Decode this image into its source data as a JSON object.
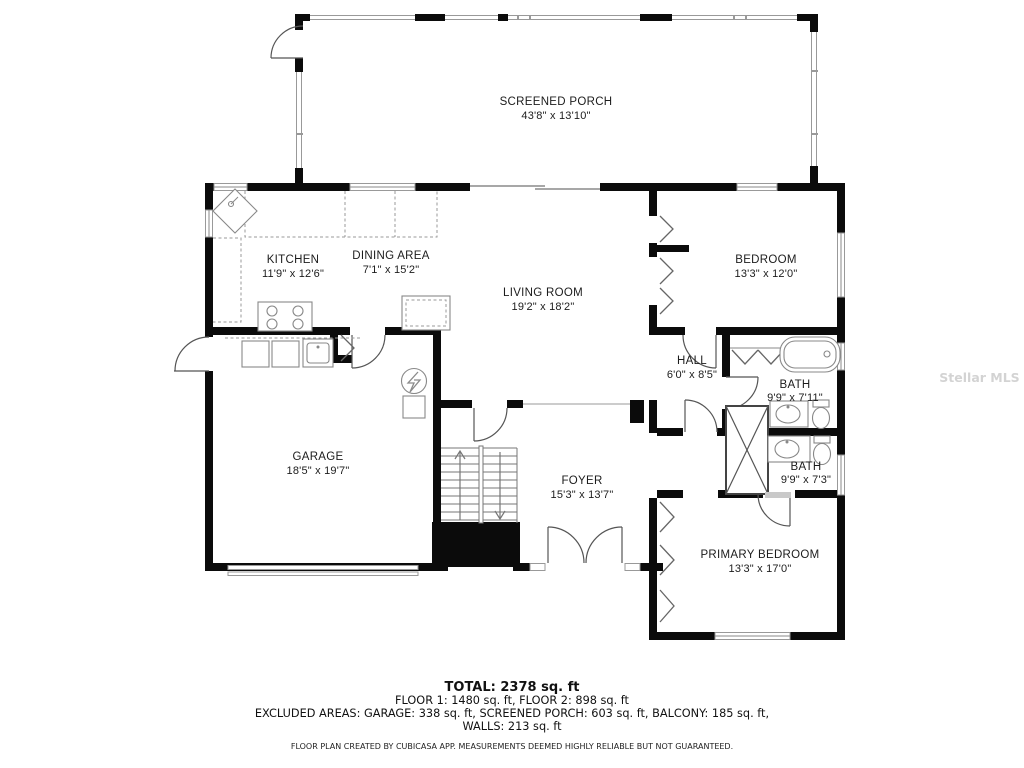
{
  "watermark": "Stellar MLS",
  "rooms": {
    "screened_porch": {
      "name": "SCREENED PORCH",
      "dims": "43'8\" x 13'10\""
    },
    "kitchen": {
      "name": "KITCHEN",
      "dims": "11'9\" x 12'6\""
    },
    "dining": {
      "name": "DINING AREA",
      "dims": "7'1\" x 15'2\""
    },
    "living": {
      "name": "LIVING ROOM",
      "dims": "19'2\" x 18'2\""
    },
    "bedroom": {
      "name": "BEDROOM",
      "dims": "13'3\" x 12'0\""
    },
    "hall": {
      "name": "HALL",
      "dims": "6'0\" x 8'5\""
    },
    "bath1": {
      "name": "BATH",
      "dims": "9'9\" x 7'11\""
    },
    "bath2": {
      "name": "BATH",
      "dims": "9'9\" x 7'3\""
    },
    "garage": {
      "name": "GARAGE",
      "dims": "18'5\" x 19'7\""
    },
    "foyer": {
      "name": "FOYER",
      "dims": "15'3\" x 13'7\""
    },
    "primary": {
      "name": "PRIMARY BEDROOM",
      "dims": "13'3\" x 17'0\""
    }
  },
  "footer": {
    "total": "TOTAL: 2378 sq. ft",
    "floors": "FLOOR 1: 1480 sq. ft, FLOOR 2: 898 sq. ft",
    "excluded": "EXCLUDED AREAS: GARAGE: 338 sq. ft, SCREENED PORCH: 603 sq. ft, BALCONY: 185 sq. ft,",
    "walls": "WALLS: 213 sq. ft",
    "disclaimer": "FLOOR PLAN CREATED BY CUBICASA APP. MEASUREMENTS DEEMED HIGHLY RELIABLE BUT NOT GUARANTEED."
  },
  "colors": {
    "wall": "#0b0b0b",
    "screen": "#999999",
    "fixture": "#888888"
  }
}
